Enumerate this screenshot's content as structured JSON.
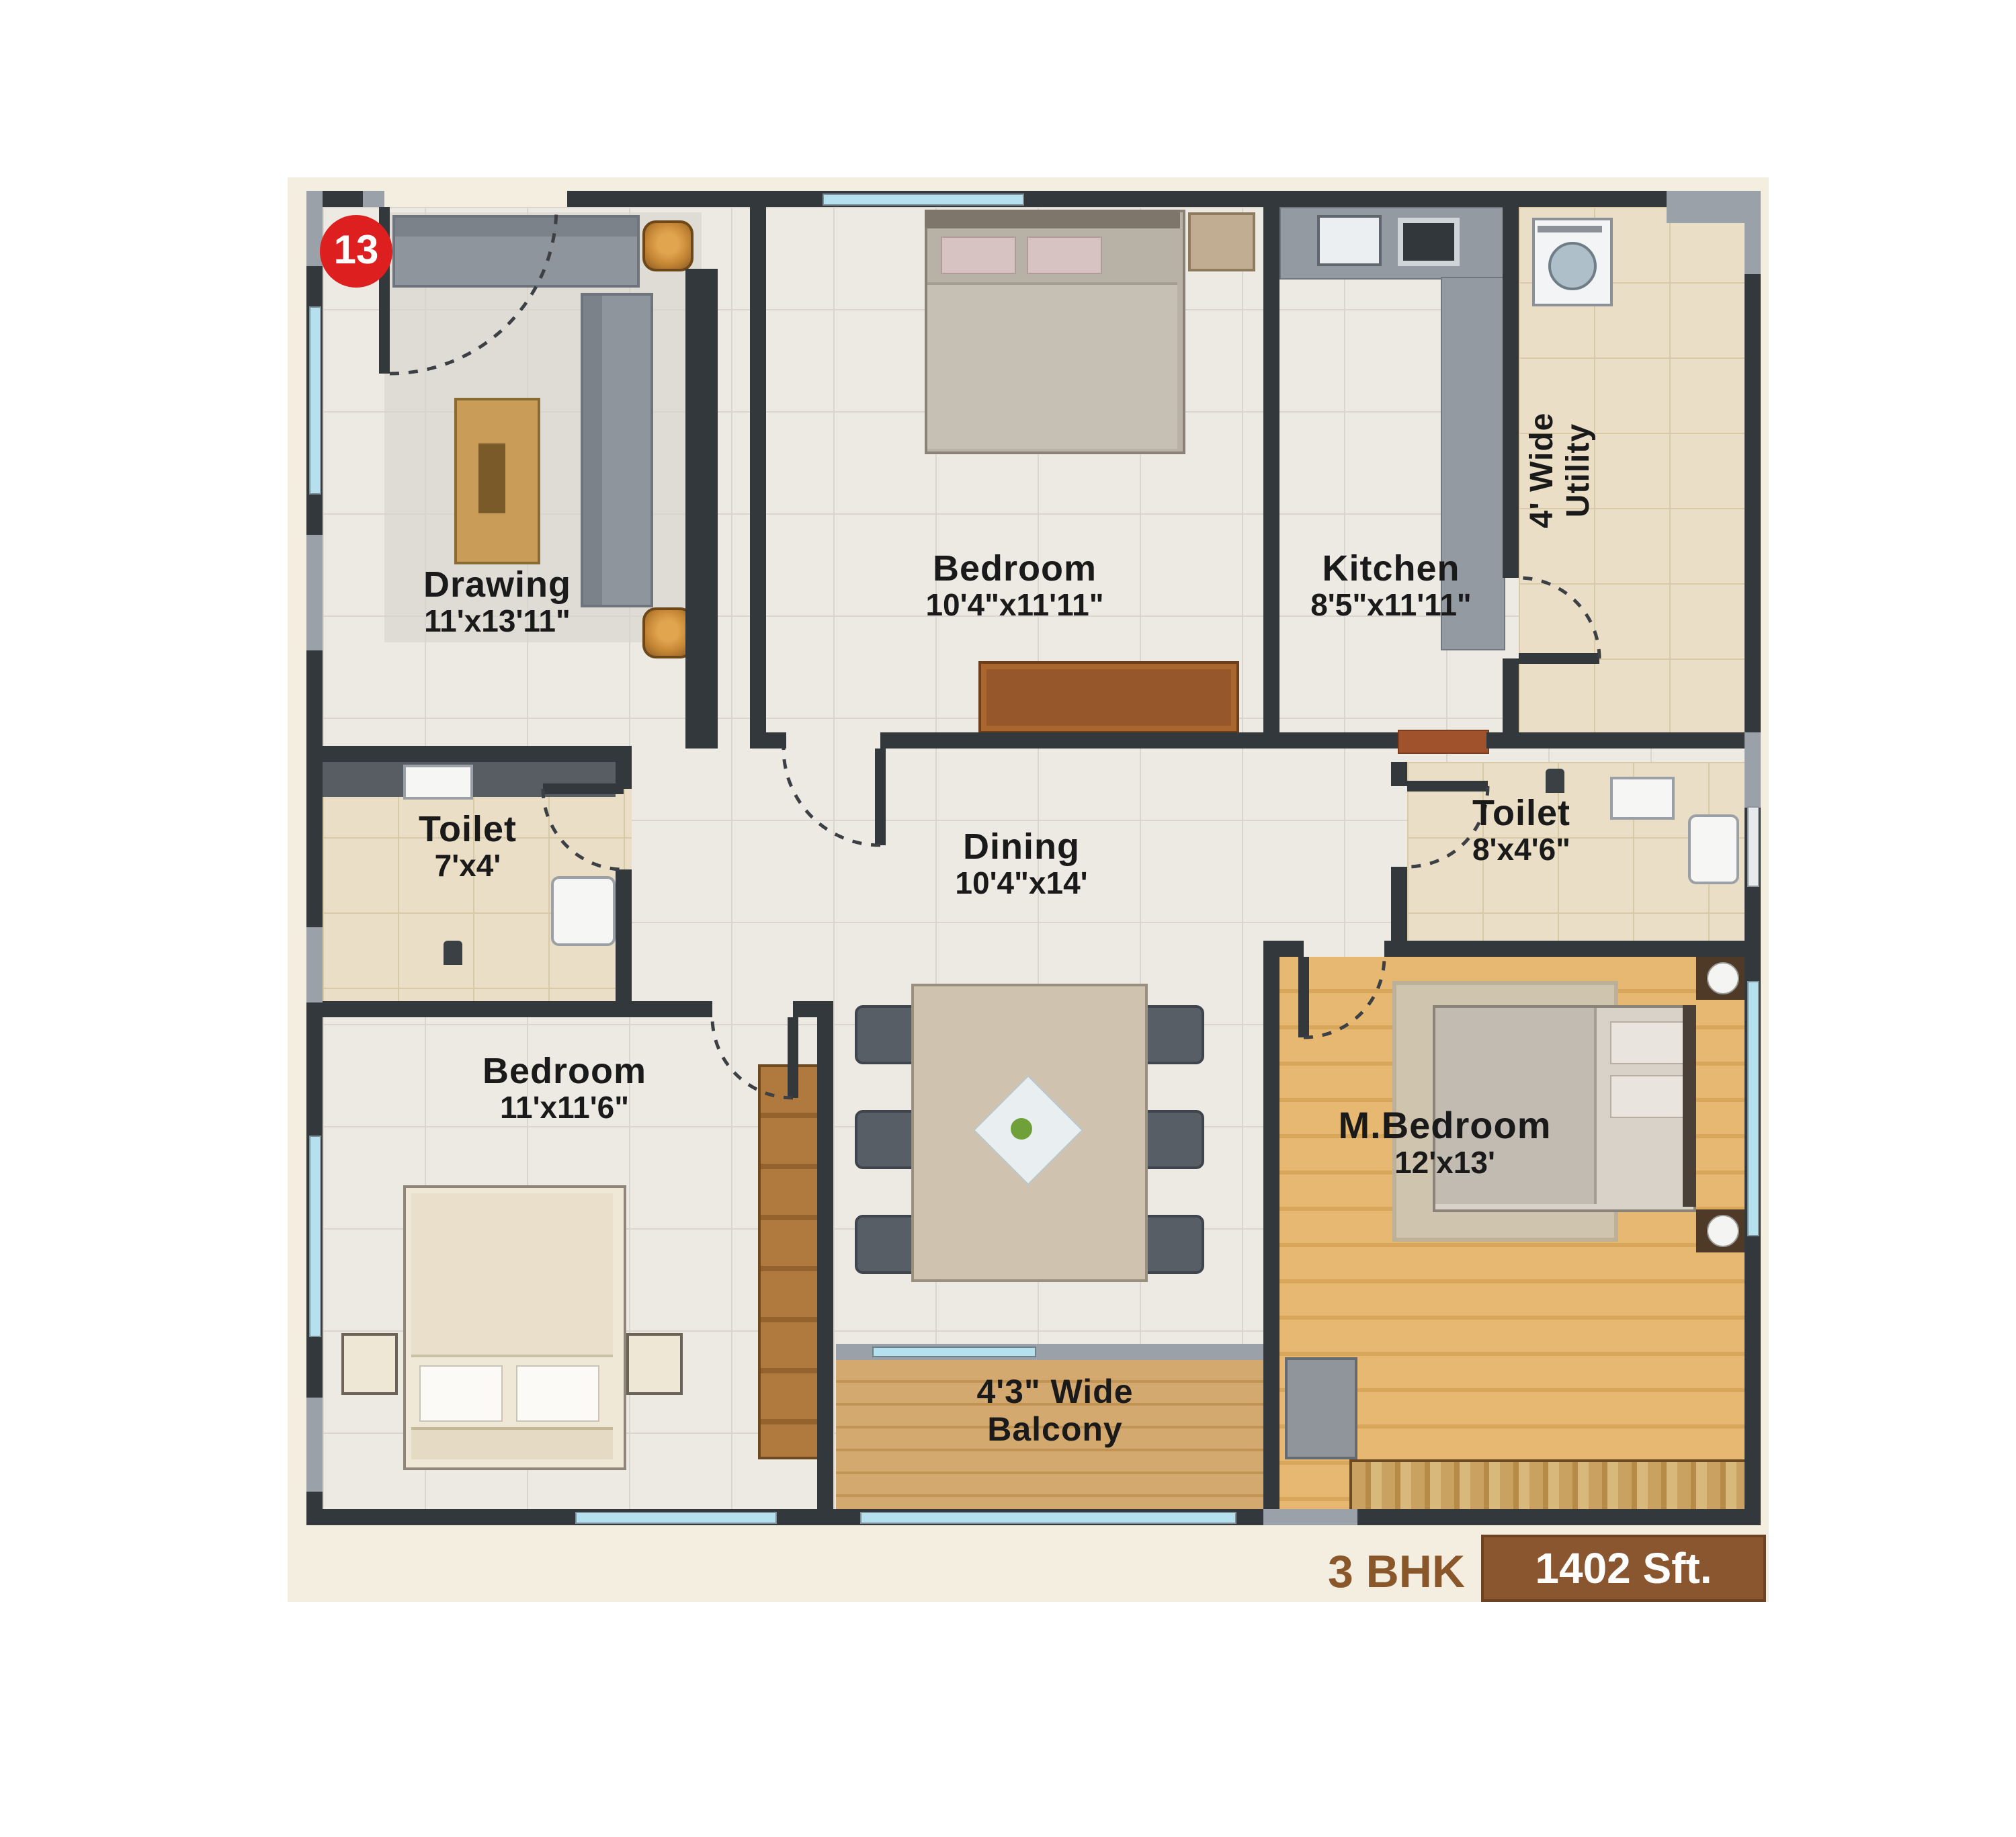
{
  "unit": {
    "number": "13"
  },
  "footer": {
    "bhk_label": "3 BHK",
    "area_label": "1402 Sft."
  },
  "rooms": {
    "drawing": {
      "name": "Drawing",
      "dims": "11'x13'11\""
    },
    "bedroom_top": {
      "name": "Bedroom",
      "dims": "10'4\"x11'11\""
    },
    "kitchen": {
      "name": "Kitchen",
      "dims": "8'5\"x11'11\""
    },
    "utility": {
      "line1": "4' Wide",
      "line2": "Utility"
    },
    "toilet_left": {
      "name": "Toilet",
      "dims": "7'x4'"
    },
    "toilet_right": {
      "name": "Toilet",
      "dims": "8'x4'6\""
    },
    "dining": {
      "name": "Dining",
      "dims": "10'4\"x14'"
    },
    "bedroom_left": {
      "name": "Bedroom",
      "dims": "11'x11'6\""
    },
    "master_bedroom": {
      "name": "M.Bedroom",
      "dims": "12'x13'"
    },
    "balcony": {
      "line1": "4'3\" Wide",
      "line2": "Balcony"
    }
  },
  "colors": {
    "wall": "#33383d",
    "wall_light": "#9aa1a8",
    "window_blue": "#b5e1ef",
    "unit_badge_red": "#dd1f1f",
    "brand_brown": "#8a5630",
    "bhk_text_brown": "#8a572b",
    "label_text": "#1a1a1a",
    "master_wood": "#e6b871",
    "balcony_wood": "#d4a96f",
    "toilet_tile": "#eadfc6",
    "main_tile": "#edeae3",
    "mat_cream": "#f4eee1",
    "door_sill_brown": "#a0522d",
    "wardrobe_wood": "#b07a3e"
  }
}
